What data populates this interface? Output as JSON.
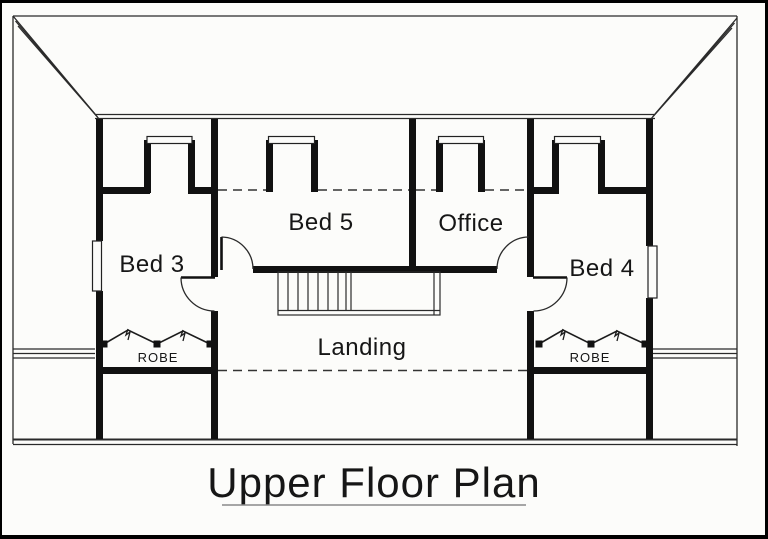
{
  "title": {
    "text": "Upper Floor Plan"
  },
  "rooms": {
    "bed3": {
      "label": "Bed 3"
    },
    "bed5": {
      "label": "Bed 5"
    },
    "office": {
      "label": "Office"
    },
    "bed4": {
      "label": "Bed 4"
    },
    "landing": {
      "label": "Landing"
    },
    "robe_left": {
      "label": "ROBE"
    },
    "robe_right": {
      "label": "ROBE"
    }
  },
  "colors": {
    "paper": "#fcfcfa",
    "ink": "#1c1c1c",
    "wall": "#111111",
    "scan_border": "#000000",
    "title_underline": "#8a8a8a"
  }
}
